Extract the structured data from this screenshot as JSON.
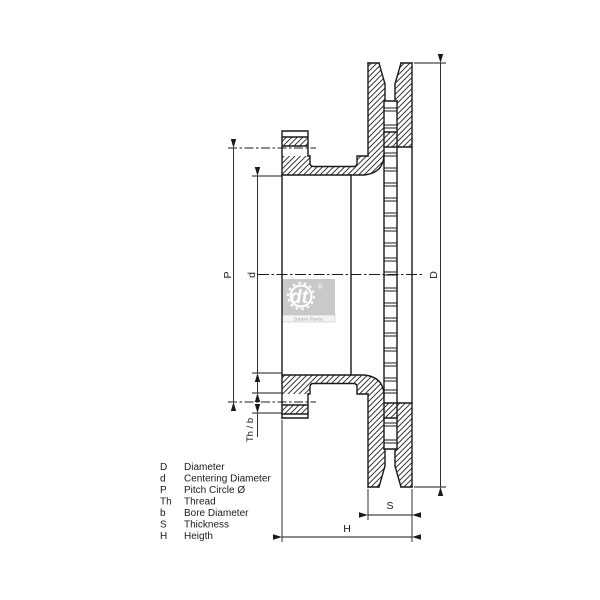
{
  "drawing_type": "brake disc cross-section technical drawing",
  "dimensions": {
    "diameter": "D",
    "centering": "d",
    "pitch_circle": "P",
    "thread_bore": "Th / b",
    "thickness": "S",
    "height": "H"
  },
  "legend": {
    "rows": [
      {
        "symbol": "D",
        "description": "Diameter"
      },
      {
        "symbol": "d",
        "description": "Centering Diameter"
      },
      {
        "symbol": "P",
        "description": "Pitch Circle Ø"
      },
      {
        "symbol": "Th",
        "description": "Thread"
      },
      {
        "symbol": "b",
        "description": "Bore Diameter"
      },
      {
        "symbol": "S",
        "description": "Thickness"
      },
      {
        "symbol": "H",
        "description": "Heigth"
      }
    ]
  },
  "logo": {
    "brand": "dt",
    "registered": "®",
    "caption": "Spare Parts"
  },
  "colors": {
    "line": "#1a1a1a",
    "background": "#ffffff",
    "logo_gray": "#c9c9c9"
  }
}
